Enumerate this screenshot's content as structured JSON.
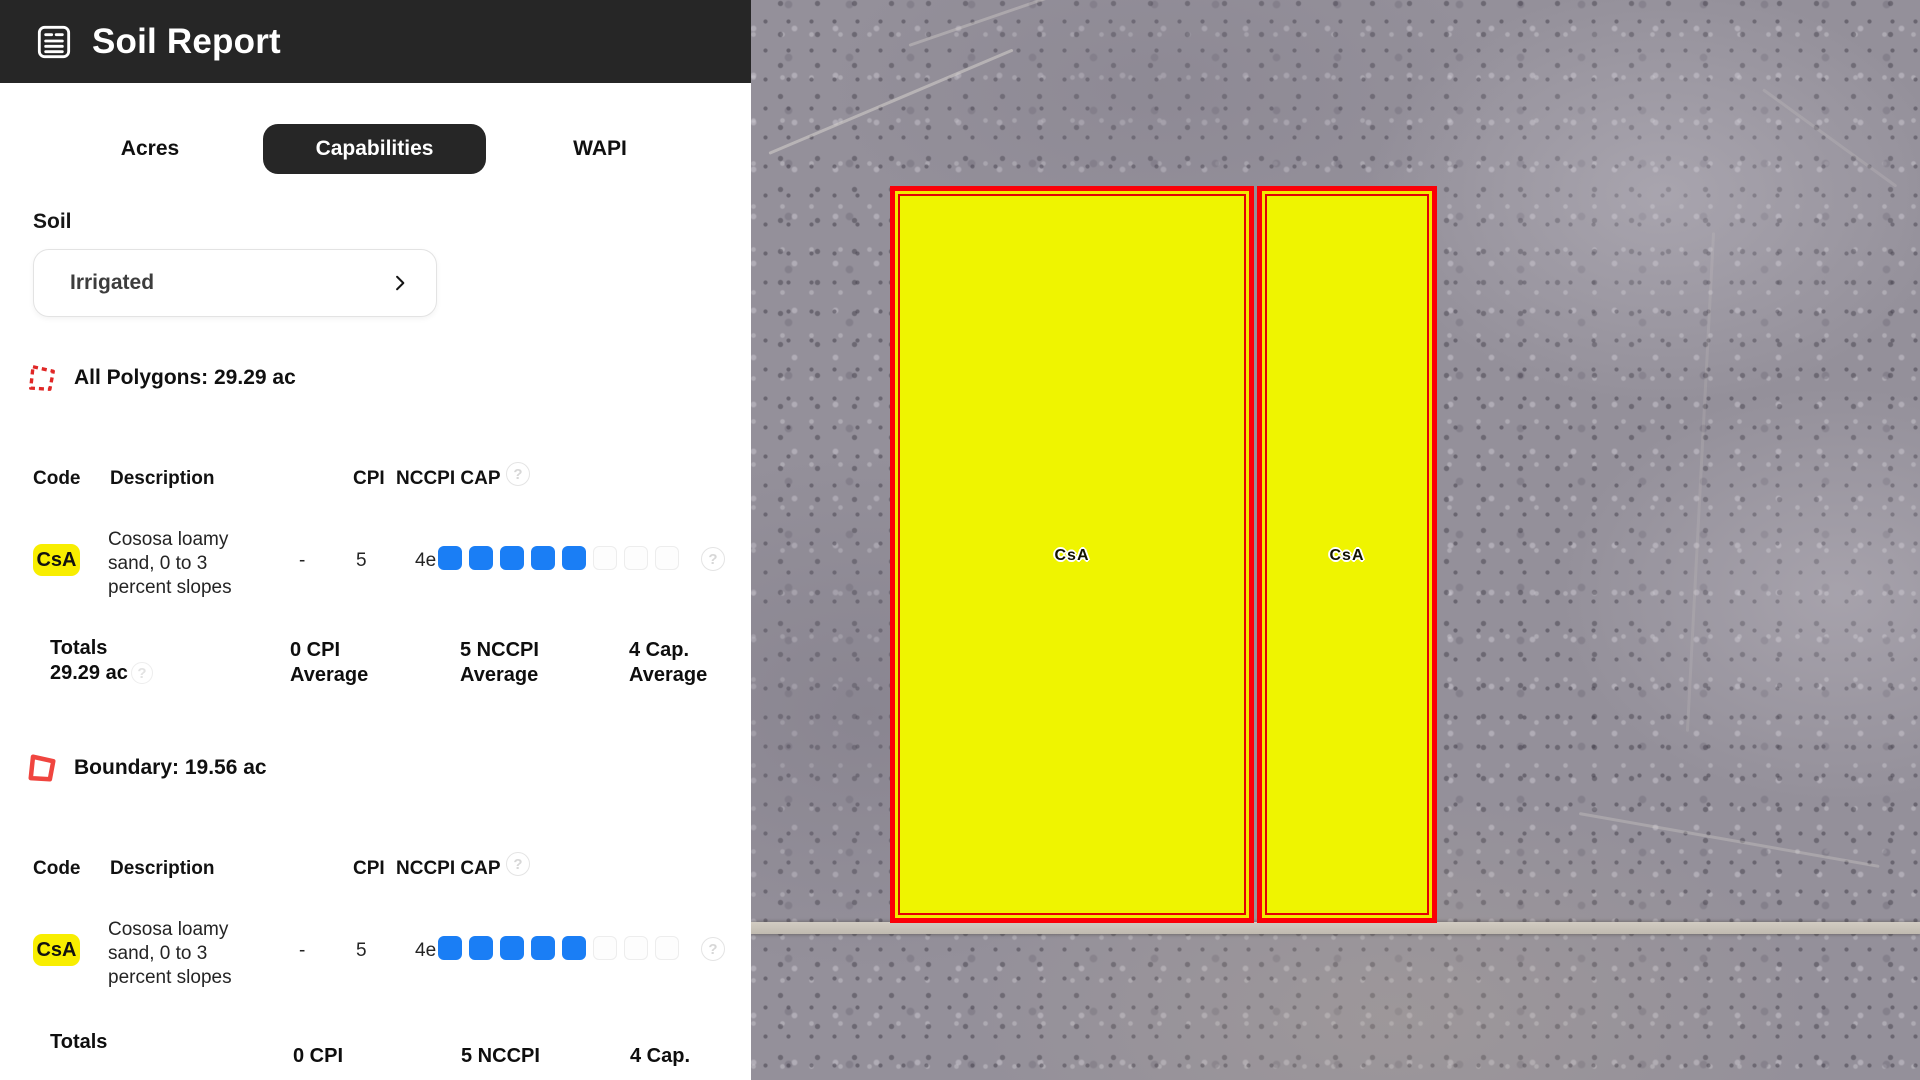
{
  "colors": {
    "appbar_bg": "#262626",
    "accent_blue": "#1a7ef5",
    "badge_yellow": "#f8ee00",
    "polygon_fill": "#eff400",
    "polygon_border": "#fb0007"
  },
  "icons": {
    "help_glyph": "?"
  },
  "header": {
    "title": "Soil Report"
  },
  "tabs": [
    {
      "label": "Acres",
      "active": false
    },
    {
      "label": "Capabilities",
      "active": true
    },
    {
      "label": "WAPI",
      "active": false
    }
  ],
  "soil": {
    "label": "Soil",
    "selected_value": "Irrigated"
  },
  "table_headers": {
    "code": "Code",
    "description": "Description",
    "cpi": "CPI",
    "nccpi_cap": "NCCPI CAP"
  },
  "capability_columns": [
    "Wildlife / Forestry",
    "Limited Grazing",
    "Moderate Grazing",
    "Intense Grazing",
    "Limited Farming",
    "Moderate Farming",
    "Intense Farming"
  ],
  "sections": [
    {
      "title": "All Polygons: 29.29 ac",
      "icon": "polygon-dashed-icon",
      "rows": [
        {
          "code": "CsA",
          "description_lines": [
            "Cososa loamy",
            "sand, 0 to 3",
            "percent slopes"
          ],
          "cpi": "-",
          "nccpi": "5",
          "cap": "4e",
          "capability_filled": 5,
          "capability_total": 8
        }
      ],
      "totals": {
        "label": "Totals",
        "acres": "29.29 ac",
        "cpi_line1": "0 CPI",
        "cpi_line2": "Average",
        "nccpi_line1": "5 NCCPI",
        "nccpi_line2": "Average",
        "cap_line1": "4 Cap.",
        "cap_line2": "Average"
      }
    },
    {
      "title": "Boundary: 19.56 ac",
      "icon": "polygon-solid-icon",
      "rows": [
        {
          "code": "CsA",
          "description_lines": [
            "Cososa loamy",
            "sand, 0 to 3",
            "percent slopes"
          ],
          "cpi": "-",
          "nccpi": "5",
          "cap": "4e",
          "capability_filled": 5,
          "capability_total": 8
        }
      ],
      "totals": {
        "label": "Totals",
        "cpi_line1": "0 CPI",
        "nccpi_line1": "5 NCCPI",
        "cap_line1": "4 Cap."
      }
    }
  ],
  "map": {
    "polygon_labels": [
      "CsA",
      "CsA"
    ]
  }
}
